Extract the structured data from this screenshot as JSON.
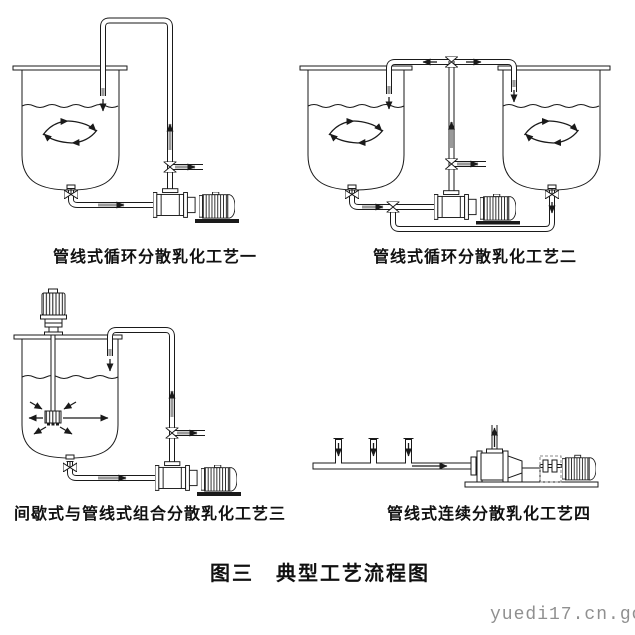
{
  "figure": {
    "title": "图三　典型工艺流程图",
    "watermark": "yuedi17.cn.go",
    "diagrams": [
      {
        "caption": "管线式循环分散乳化工艺一"
      },
      {
        "caption": "管线式循环分散乳化工艺二"
      },
      {
        "caption": "间歇式与管线式组合分散乳化工艺三"
      },
      {
        "caption": "管线式连续分散乳化工艺四"
      }
    ],
    "colors": {
      "ink": "#1a1a1a",
      "background": "#ffffff",
      "watermark_gray": "#909090",
      "flow_arrow_gray": "#9a9a9a"
    }
  }
}
